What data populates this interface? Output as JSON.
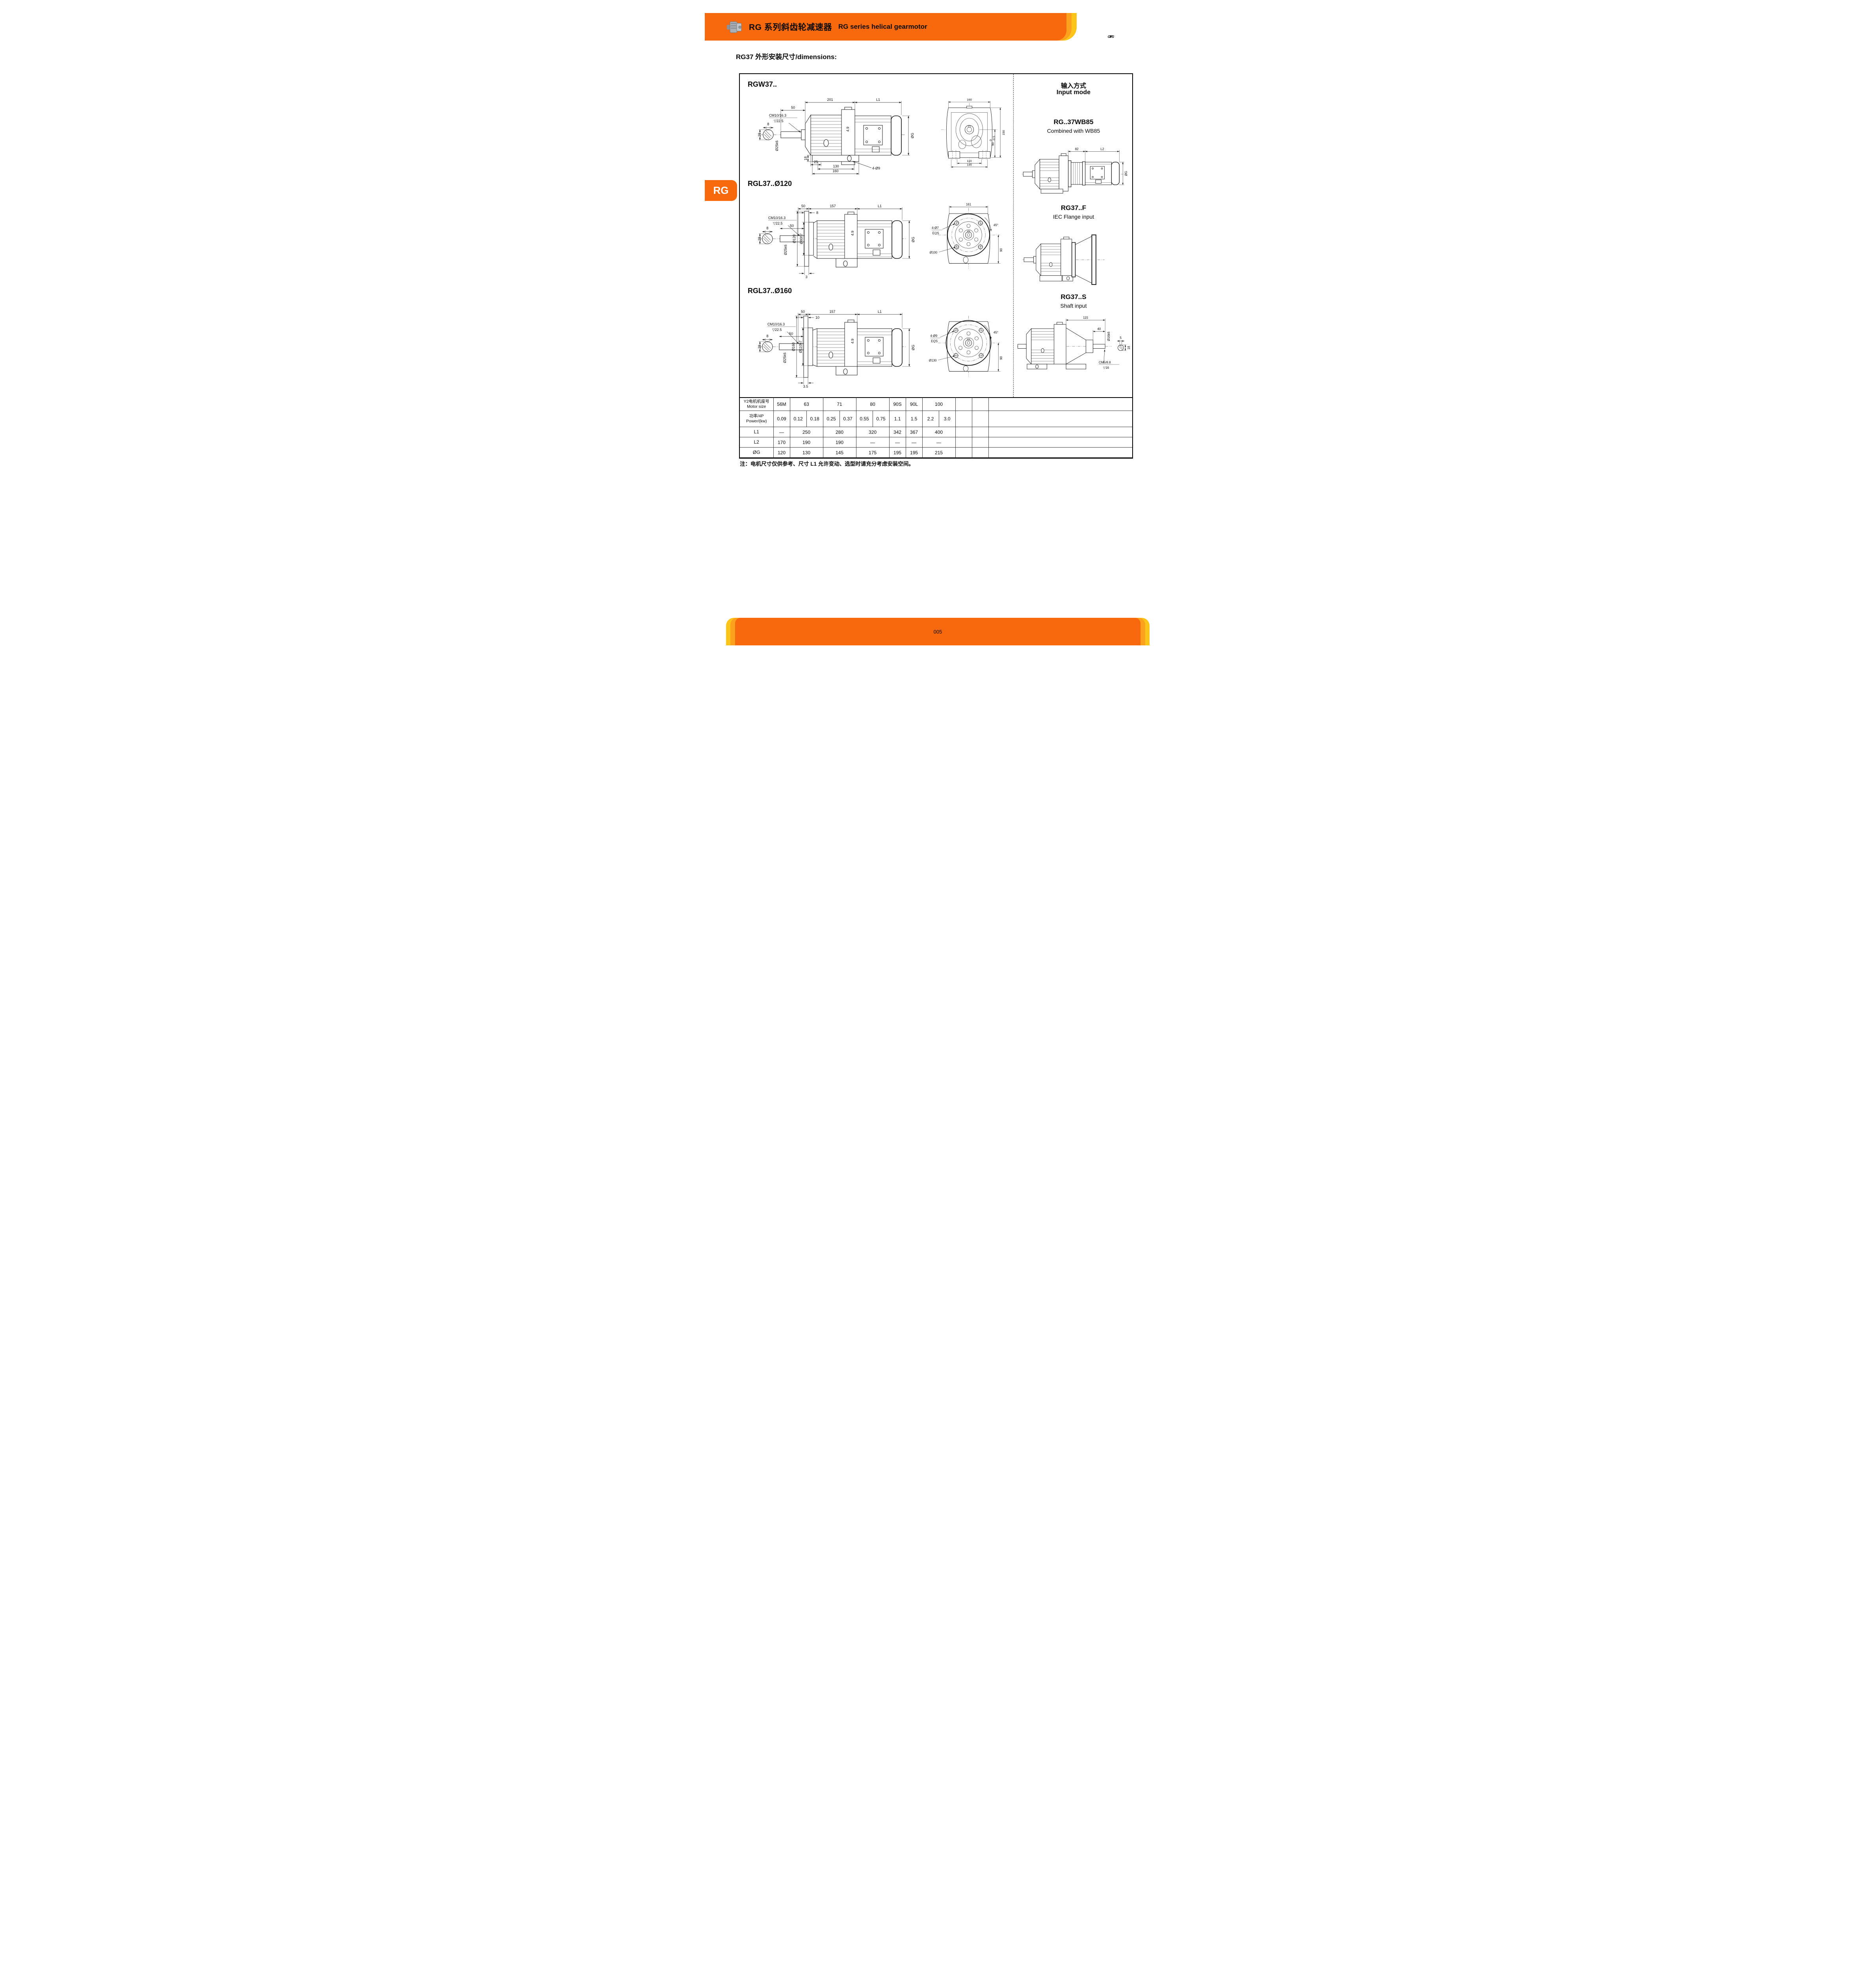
{
  "colors": {
    "orange": "#F8690D",
    "amber": "#FBA11E",
    "yellow": "#FDC41A",
    "logo_orange": "#E4571E"
  },
  "header": {
    "title_zh": "RG 系列斜齿轮减速器",
    "title_en": "RG series helical gearmotor",
    "logo_text": "GTPG"
  },
  "page": {
    "subtitle": "RG37 外形安装尺寸/dimensions:",
    "side_tab": "RG",
    "page_number": "005",
    "note": "注：电机尺寸仅供参考、尺寸 L1 允许变动、选型时请充分考虑安装空间。"
  },
  "sections": {
    "rgw37_label": "RGW37..",
    "rgl120_label": "RGL37..Ø120",
    "rgl160_label": "RGL37..Ø160"
  },
  "input_modes": {
    "title_zh": "输入方式",
    "title_en": "Input mode",
    "wb85_code": "RG..37WB85",
    "wb85_desc": "Combined with WB85",
    "flange_code": "RG37..F",
    "flange_desc": "IEC Flange input",
    "shaft_code": "RG37..S",
    "shaft_desc": "Shaft input"
  },
  "dims": {
    "rgw_side": {
      "top1": "201",
      "top2": "L1",
      "len50": "50",
      "cm": "CM10/16.3",
      "depth": "▽22.5",
      "key8": "8",
      "key28": "28",
      "shaft": "Ø25k6",
      "gap49": "4.9",
      "off25": "25",
      "foot18": "18",
      "bolt130": "130",
      "base160": "160",
      "holes": "4-Ø9",
      "og": "ØG"
    },
    "rgw_front": {
      "w160": "160",
      "h150": "150",
      "h90": "90",
      "tol_top": "0",
      "tol_bot": "-0.5",
      "w110": "110",
      "w145": "145"
    },
    "rgl120_side": {
      "top50": "50",
      "top157": "157",
      "topL1": "L1",
      "cm": "CM10/16.3",
      "depth": "▽22.5",
      "lip8": "8",
      "key8": "8",
      "key28": "28",
      "flange": "Ø120",
      "hub": "Ø80h7",
      "shaft": "Ø25k6",
      "len50": "50",
      "gap49": "4.9",
      "off3": "3",
      "og": "ØG"
    },
    "rgl120_front": {
      "w161": "161",
      "holes": "4-Ø7",
      "eqs": "EQS",
      "bc": "Ø100",
      "ang": "45°",
      "h90": "90"
    },
    "rgl160_side": {
      "top50": "50",
      "top157": "157",
      "topL1": "L1",
      "cm": "CM10/16.3",
      "depth": "▽22.5",
      "lip10": "10",
      "key8": "8",
      "key28": "28",
      "flange": "Ø160",
      "hub": "Ø110h7",
      "shaft": "Ø25k6",
      "len50": "50",
      "gap49": "4.9",
      "off35": "3.5",
      "og": "ØG"
    },
    "rgl160_front": {
      "holes": "4-Ø9",
      "eqs": "EQS",
      "bc": "Ø130",
      "ang": "45°",
      "h90": "90"
    },
    "wb85": {
      "top82": "82",
      "topL2": "L2",
      "og": "ØG"
    },
    "shaft_in": {
      "top115": "115",
      "top40": "40",
      "shaft": "Ø16k6",
      "cm": "CM5/8.8",
      "depth": "▽16",
      "key5": "5",
      "key18": "18"
    }
  },
  "table": {
    "rows": [
      {
        "key": "motor",
        "label1": "Y2电机机座号",
        "label2": "Motor size",
        "cells": [
          {
            "v": "56M",
            "s": 1
          },
          {
            "v": "63",
            "s": 2
          },
          {
            "v": "71",
            "s": 2
          },
          {
            "v": "80",
            "s": 2
          },
          {
            "v": "90S",
            "s": 1
          },
          {
            "v": "90L",
            "s": 1
          },
          {
            "v": "100",
            "s": 2
          },
          {
            "v": "",
            "s": 1
          },
          {
            "v": "",
            "s": 1
          },
          {
            "v": "",
            "s": 1
          }
        ]
      },
      {
        "key": "power",
        "label1": "功率/4P",
        "label2": "Power/(kw)",
        "cells": [
          {
            "v": "0.09",
            "s": 1
          },
          {
            "v": "0.12",
            "s": 1
          },
          {
            "v": "0.18",
            "s": 1
          },
          {
            "v": "0.25",
            "s": 1
          },
          {
            "v": "0.37",
            "s": 1
          },
          {
            "v": "0.55",
            "s": 1
          },
          {
            "v": "0.75",
            "s": 1
          },
          {
            "v": "1.1",
            "s": 1
          },
          {
            "v": "1.5",
            "s": 1
          },
          {
            "v": "2.2",
            "s": 1
          },
          {
            "v": "3.0",
            "s": 1
          },
          {
            "v": "",
            "s": 1
          },
          {
            "v": "",
            "s": 1
          },
          {
            "v": "",
            "s": 1
          }
        ]
      },
      {
        "key": "L1",
        "label1": "L1",
        "cells": [
          {
            "v": "—",
            "s": 1
          },
          {
            "v": "250",
            "s": 2
          },
          {
            "v": "280",
            "s": 2
          },
          {
            "v": "320",
            "s": 2
          },
          {
            "v": "342",
            "s": 1
          },
          {
            "v": "367",
            "s": 1
          },
          {
            "v": "400",
            "s": 2
          },
          {
            "v": "",
            "s": 1
          },
          {
            "v": "",
            "s": 1
          },
          {
            "v": "",
            "s": 1
          }
        ]
      },
      {
        "key": "L2",
        "label1": "L2",
        "cells": [
          {
            "v": "170",
            "s": 1
          },
          {
            "v": "190",
            "s": 2
          },
          {
            "v": "190",
            "s": 2
          },
          {
            "v": "—",
            "s": 2
          },
          {
            "v": "—",
            "s": 1
          },
          {
            "v": "—",
            "s": 1
          },
          {
            "v": "—",
            "s": 2
          },
          {
            "v": "",
            "s": 1
          },
          {
            "v": "",
            "s": 1
          },
          {
            "v": "",
            "s": 1
          }
        ]
      },
      {
        "key": "OG",
        "label1": "ØG",
        "cells": [
          {
            "v": "120",
            "s": 1
          },
          {
            "v": "130",
            "s": 2
          },
          {
            "v": "145",
            "s": 2
          },
          {
            "v": "175",
            "s": 2
          },
          {
            "v": "195",
            "s": 1
          },
          {
            "v": "195",
            "s": 1
          },
          {
            "v": "215",
            "s": 2
          },
          {
            "v": "",
            "s": 1
          },
          {
            "v": "",
            "s": 1
          },
          {
            "v": "",
            "s": 1
          }
        ]
      }
    ]
  }
}
